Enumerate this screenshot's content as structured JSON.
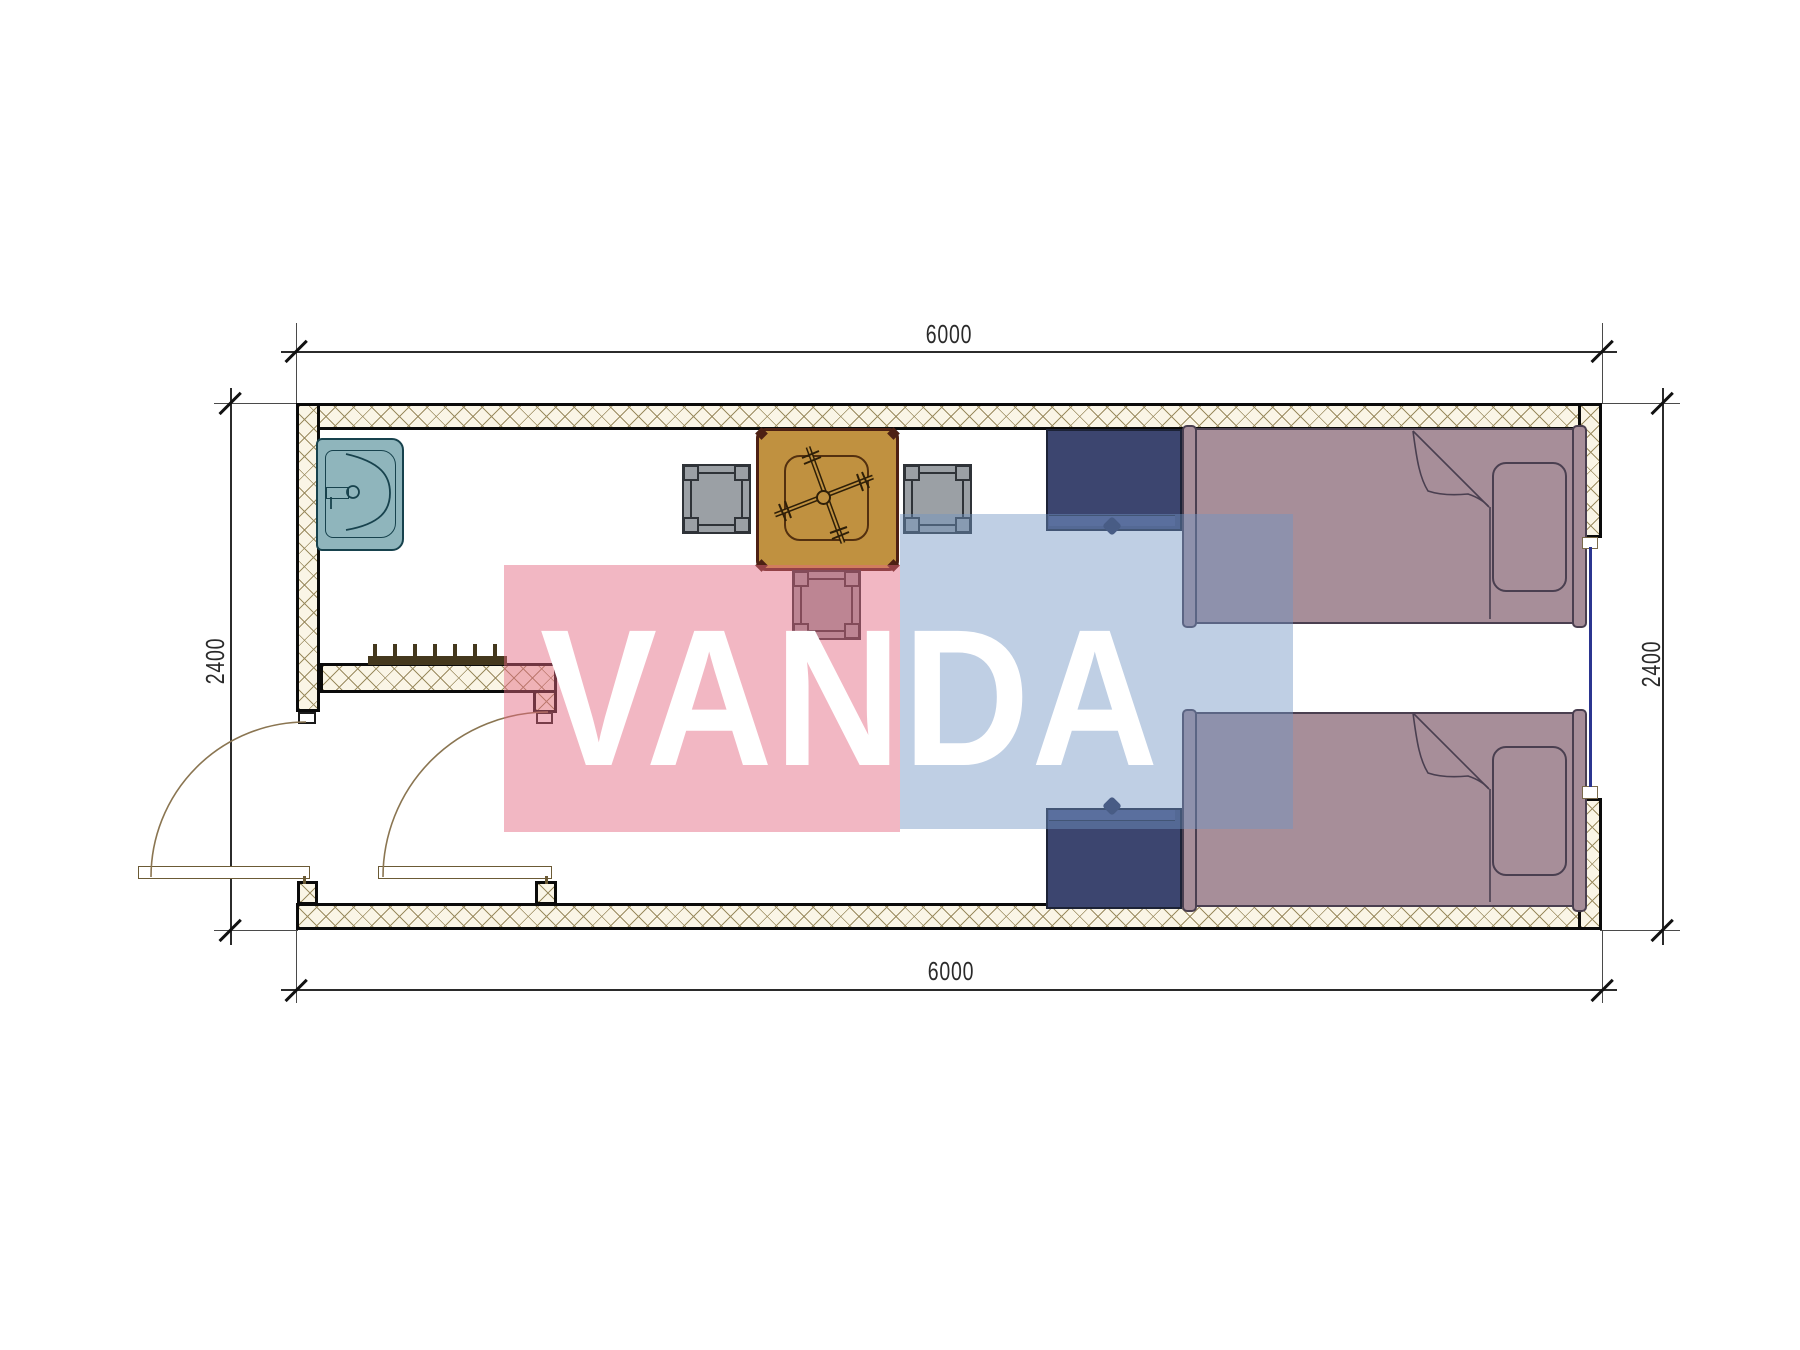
{
  "drawing": {
    "type": "floor-plan",
    "room": "container room with bathroom-entry, dining set, two single beds"
  },
  "dimensions": {
    "top": "6000",
    "bottom": "6000",
    "left": "2400",
    "right": "2400"
  },
  "watermark": {
    "text": "VANDA",
    "pink_hex": "#E4667F",
    "blue_hex": "#7195C4"
  },
  "colors": {
    "wall-fill": "#FAF5E6",
    "wall-hatch": "#9B8C60",
    "wall-line": "#0A0A0A",
    "bed": "#A78E99",
    "bed-line": "#4A3F50",
    "table": "#C09140",
    "table-line": "#4D2013",
    "chair": "#9BA0A5",
    "chair-line": "#2F3338",
    "nightstand": "#3C456F",
    "nightstand-line": "#1C2236",
    "sink": "#8FB5BC",
    "sink-line": "#17424D",
    "window": "#2B3590",
    "door": "#8A7551",
    "rack": "#44381D",
    "wm-pink": "rgba(228,102,128,0.47)",
    "wm-blue": "rgba(113,149,196,0.45)"
  }
}
